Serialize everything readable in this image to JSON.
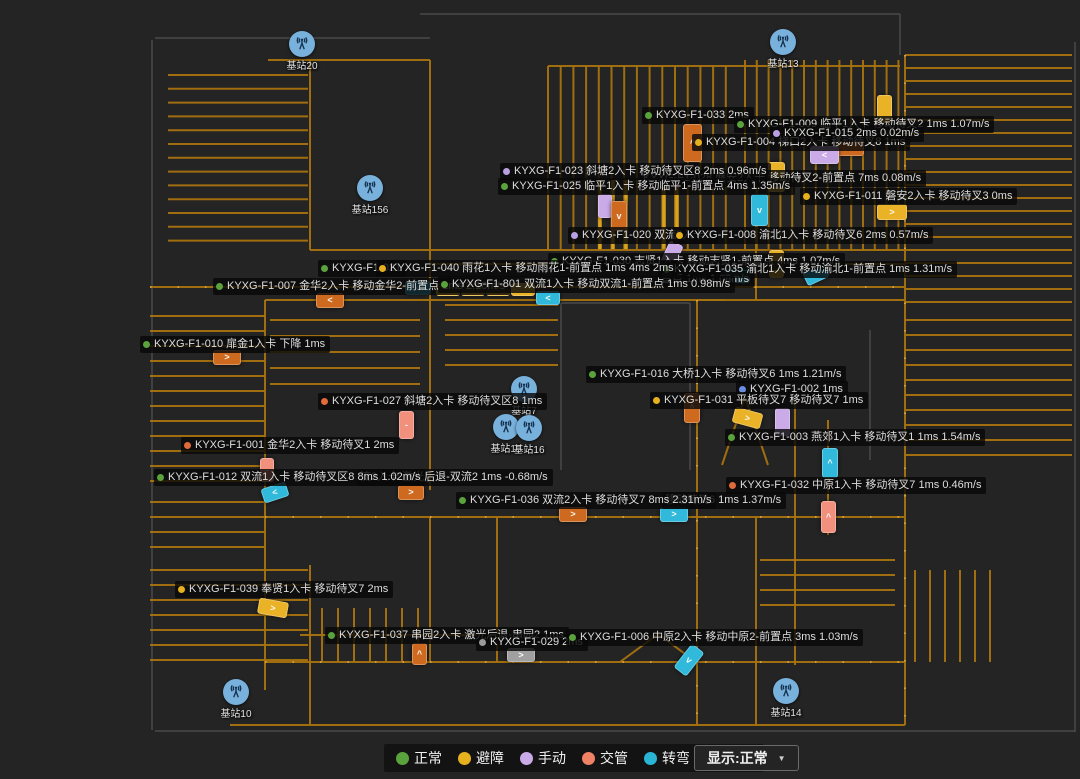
{
  "map": {
    "background": "#242424",
    "road_color": "#a8730f",
    "road_bright_color": "#d9a31d",
    "station_icon_color": "#79b1dd"
  },
  "palette": {
    "dot": {
      "green": "#5aa33c",
      "yellow": "#e6b01f",
      "purple": "#b9a0e2",
      "blue": "#6b8ce0",
      "orange": "#e06a3a",
      "gray": "#9a9a9a"
    },
    "vehicle": {
      "orange": "#cd6a1f",
      "salmon": "#f2907e",
      "yellow": "#e9b227",
      "cyan": "#30b9da",
      "purple": "#cbaae8",
      "gray": "#a0a0a0"
    }
  },
  "legend": {
    "items": [
      {
        "label": "正常",
        "color": "#5aa33c"
      },
      {
        "label": "避障",
        "color": "#e6b01f"
      },
      {
        "label": "手动",
        "color": "#cbaae8"
      },
      {
        "label": "交管",
        "color": "#ef8165"
      },
      {
        "label": "转弯",
        "color": "#2ab5d5"
      },
      {
        "label": "定位",
        "color": "#6b8ce0"
      }
    ],
    "display_selector": {
      "label": "显示:正常",
      "caret": "▼"
    }
  },
  "stations": [
    {
      "label": "基站20",
      "x": 302,
      "y": 44
    },
    {
      "label": "基站13",
      "x": 783,
      "y": 42
    },
    {
      "label": "基站156",
      "x": 370,
      "y": 188
    },
    {
      "label": "基站7",
      "x": 524,
      "y": 389
    },
    {
      "label": "基站15",
      "x": 506,
      "y": 427
    },
    {
      "label": "基站16",
      "x": 529,
      "y": 428
    },
    {
      "label": "基站10",
      "x": 236,
      "y": 692
    },
    {
      "label": "基站14",
      "x": 786,
      "y": 691
    }
  ],
  "labels": [
    {
      "x": 642,
      "y": 107,
      "dot": "green",
      "text": "KYXG-F1-033 2ms"
    },
    {
      "x": 734,
      "y": 116,
      "dot": "green",
      "text": "KYXG-F1-009 临平1入卡 移动待叉2 1ms 1.07m/s"
    },
    {
      "x": 692,
      "y": 134,
      "dot": "yellow",
      "text": "KYXG-F1-004 梯口2入卡 移动待叉8 1ms"
    },
    {
      "x": 770,
      "y": 125,
      "dot": "purple",
      "text": "KYXG-F1-015 2ms 0.02m/s"
    },
    {
      "x": 640,
      "y": 170,
      "dot": null,
      "text": "KYXG-F1-028 磐安2入卡 移动待叉2-前置点 7ms 0.08m/s"
    },
    {
      "x": 500,
      "y": 163,
      "dot": "purple",
      "text": "KYXG-F1-023 斜塘2入卡 移动待叉区8 2ms 0.96m/s"
    },
    {
      "x": 498,
      "y": 178,
      "dot": "green",
      "text": "KYXG-F1-025 临平1入卡 移动临平1-前置点 4ms 1.35m/s"
    },
    {
      "x": 800,
      "y": 188,
      "dot": "yellow",
      "text": "KYXG-F1-011 磐安2入卡 移动待叉3 0ms"
    },
    {
      "x": 568,
      "y": 227,
      "dot": "purple",
      "text": "KYXG-F1-020 双流2入卡 1"
    },
    {
      "x": 673,
      "y": 227,
      "dot": "yellow",
      "text": "KYXG-F1-008 渝北1入卡 移动待叉6 2ms 0.57m/s"
    },
    {
      "x": 548,
      "y": 253,
      "dot": "green",
      "text": "KYXG-F1-030 志贤1入卡 移动志贤1-前置点 4ms 1.07m/s"
    },
    {
      "x": 658,
      "y": 271,
      "dot": null,
      "text": "置点 1ms 1.08m/s"
    },
    {
      "x": 660,
      "y": 261,
      "dot": "green",
      "text": "KYXG-F1-035 渝北1入卡 移动渝北1-前置点 1ms 1.31m/s"
    },
    {
      "x": 318,
      "y": 260,
      "dot": "green",
      "text": "KYXG-F1-021"
    },
    {
      "x": 376,
      "y": 260,
      "dot": "yellow",
      "text": "KYXG-F1-040 雨花1入卡 移动雨花1-前置点 1ms 4ms 2ms"
    },
    {
      "x": 213,
      "y": 278,
      "dot": "green",
      "text": "KYXG-F1-007 金华2入卡 移动金华2-前置点 1ms 2.10m/s"
    },
    {
      "x": 438,
      "y": 276,
      "dot": "green",
      "text": "KYXG-F1-801 双流1入卡 移动双流1-前置点 1ms 0.98m/s"
    },
    {
      "x": 140,
      "y": 336,
      "dot": "green",
      "text": "KYXG-F1-010 扉金1入卡 下降 1ms"
    },
    {
      "x": 586,
      "y": 366,
      "dot": "green",
      "text": "KYXG-F1-016 大桥1入卡 移动待叉6 1ms 1.21m/s"
    },
    {
      "x": 736,
      "y": 381,
      "dot": "blue",
      "text": "KYXG-F1-002 1ms"
    },
    {
      "x": 650,
      "y": 392,
      "dot": "yellow",
      "text": "KYXG-F1-031 平板待叉7 移动待叉7 1ms"
    },
    {
      "x": 318,
      "y": 393,
      "dot": "orange",
      "text": "KYXG-F1-027 斜塘2入卡 移动待叉区8 1ms"
    },
    {
      "x": 725,
      "y": 429,
      "dot": "green",
      "text": "KYXG-F1-003 燕郊1入卡 移动待叉1 1ms 1.54m/s"
    },
    {
      "x": 181,
      "y": 437,
      "dot": "orange",
      "text": "KYXG-F1-001 金华2入卡 移动待叉1 2ms"
    },
    {
      "x": 357,
      "y": 469,
      "dot": null,
      "text": "流2入卡 激光后退-双流2 1ms -0.68m/s"
    },
    {
      "x": 154,
      "y": 469,
      "dot": "green",
      "text": "KYXG-F1-012 双流1入卡 移动待叉区8 8ms 1.02m/s"
    },
    {
      "x": 726,
      "y": 477,
      "dot": "orange",
      "text": "KYXG-F1-032 中原1入卡 移动待叉7 1ms 0.46m/s"
    },
    {
      "x": 662,
      "y": 492,
      "dot": null,
      "text": "移动待叉6 1ms 1.37m/s"
    },
    {
      "x": 456,
      "y": 492,
      "dot": "green",
      "text": "KYXG-F1-036 双流2入卡 移动待叉7 8ms 2.31m/s"
    },
    {
      "x": 175,
      "y": 581,
      "dot": "yellow",
      "text": "KYXG-F1-039 奉贤1入卡 移动待叉7 2ms"
    },
    {
      "x": 325,
      "y": 627,
      "dot": "green",
      "text": "KYXG-F1-037 串园2入卡 激光后退-串园2 1ms"
    },
    {
      "x": 476,
      "y": 634,
      "dot": "gray",
      "text": "KYXG-F1-029 2ms"
    },
    {
      "x": 566,
      "y": 629,
      "dot": "green",
      "text": "KYXG-F1-006 中原2入卡 移动中原2-前置点 3ms 1.03m/s"
    }
  ],
  "vehicles": [
    {
      "x": 683,
      "y": 124,
      "w": 17,
      "h": 36,
      "c": "orange",
      "g": "^"
    },
    {
      "x": 877,
      "y": 95,
      "w": 13,
      "h": 26,
      "c": "yellow",
      "g": ""
    },
    {
      "x": 836,
      "y": 141,
      "w": 26,
      "h": 13,
      "c": "orange",
      "g": ""
    },
    {
      "x": 810,
      "y": 146,
      "w": 27,
      "h": 16,
      "c": "purple",
      "g": "<"
    },
    {
      "x": 768,
      "y": 162,
      "w": 15,
      "h": 28,
      "c": "yellow",
      "g": "="
    },
    {
      "x": 877,
      "y": 204,
      "w": 28,
      "h": 14,
      "c": "yellow",
      "g": ">"
    },
    {
      "x": 598,
      "y": 194,
      "w": 12,
      "h": 22,
      "c": "purple",
      "g": ""
    },
    {
      "x": 611,
      "y": 201,
      "w": 14,
      "h": 28,
      "c": "orange",
      "g": "v"
    },
    {
      "x": 751,
      "y": 194,
      "w": 15,
      "h": 30,
      "c": "cyan",
      "g": "v"
    },
    {
      "x": 769,
      "y": 250,
      "w": 13,
      "h": 26,
      "c": "yellow",
      "g": ""
    },
    {
      "x": 664,
      "y": 242,
      "w": 13,
      "h": 24,
      "c": "purple",
      "a": 25,
      "g": ""
    },
    {
      "x": 724,
      "y": 268,
      "w": 24,
      "h": 13,
      "c": "cyan",
      "g": "<"
    },
    {
      "x": 804,
      "y": 267,
      "w": 22,
      "h": 13,
      "c": "cyan",
      "a": -25,
      "g": ""
    },
    {
      "x": 316,
      "y": 293,
      "w": 26,
      "h": 13,
      "c": "orange",
      "g": "<"
    },
    {
      "x": 405,
      "y": 281,
      "w": 24,
      "h": 12,
      "c": "cyan",
      "g": "<"
    },
    {
      "x": 436,
      "y": 283,
      "w": 22,
      "h": 11,
      "c": "yellow",
      "g": ""
    },
    {
      "x": 461,
      "y": 283,
      "w": 22,
      "h": 11,
      "c": "yellow",
      "g": ""
    },
    {
      "x": 486,
      "y": 283,
      "w": 22,
      "h": 11,
      "c": "yellow",
      "g": ""
    },
    {
      "x": 511,
      "y": 283,
      "w": 22,
      "h": 11,
      "c": "yellow",
      "g": ""
    },
    {
      "x": 536,
      "y": 291,
      "w": 22,
      "h": 12,
      "c": "cyan",
      "g": "<"
    },
    {
      "x": 213,
      "y": 350,
      "w": 26,
      "h": 13,
      "c": "orange",
      "g": ">"
    },
    {
      "x": 399,
      "y": 411,
      "w": 13,
      "h": 26,
      "c": "salmon",
      "g": "-"
    },
    {
      "x": 684,
      "y": 393,
      "w": 14,
      "h": 28,
      "c": "orange",
      "g": "^"
    },
    {
      "x": 733,
      "y": 410,
      "w": 27,
      "h": 14,
      "c": "yellow",
      "a": 15,
      "g": ">"
    },
    {
      "x": 775,
      "y": 408,
      "w": 13,
      "h": 26,
      "c": "purple",
      "g": ""
    },
    {
      "x": 822,
      "y": 448,
      "w": 14,
      "h": 28,
      "c": "cyan",
      "g": "^"
    },
    {
      "x": 260,
      "y": 458,
      "w": 12,
      "h": 22,
      "c": "salmon",
      "g": "-"
    },
    {
      "x": 262,
      "y": 485,
      "w": 24,
      "h": 13,
      "c": "cyan",
      "a": -18,
      "g": "<"
    },
    {
      "x": 398,
      "y": 485,
      "w": 24,
      "h": 13,
      "c": "orange",
      "g": ">"
    },
    {
      "x": 559,
      "y": 507,
      "w": 26,
      "h": 13,
      "c": "orange",
      "g": ">"
    },
    {
      "x": 660,
      "y": 507,
      "w": 26,
      "h": 13,
      "c": "cyan",
      "g": ">"
    },
    {
      "x": 821,
      "y": 501,
      "w": 13,
      "h": 30,
      "c": "salmon",
      "g": "^"
    },
    {
      "x": 258,
      "y": 600,
      "w": 28,
      "h": 14,
      "c": "yellow",
      "a": 10,
      "g": ">"
    },
    {
      "x": 412,
      "y": 643,
      "w": 13,
      "h": 20,
      "c": "orange",
      "g": "^"
    },
    {
      "x": 507,
      "y": 648,
      "w": 26,
      "h": 12,
      "c": "gray",
      "g": ">"
    },
    {
      "x": 681,
      "y": 645,
      "w": 14,
      "h": 28,
      "c": "cyan",
      "a": 38,
      "g": "v"
    }
  ]
}
